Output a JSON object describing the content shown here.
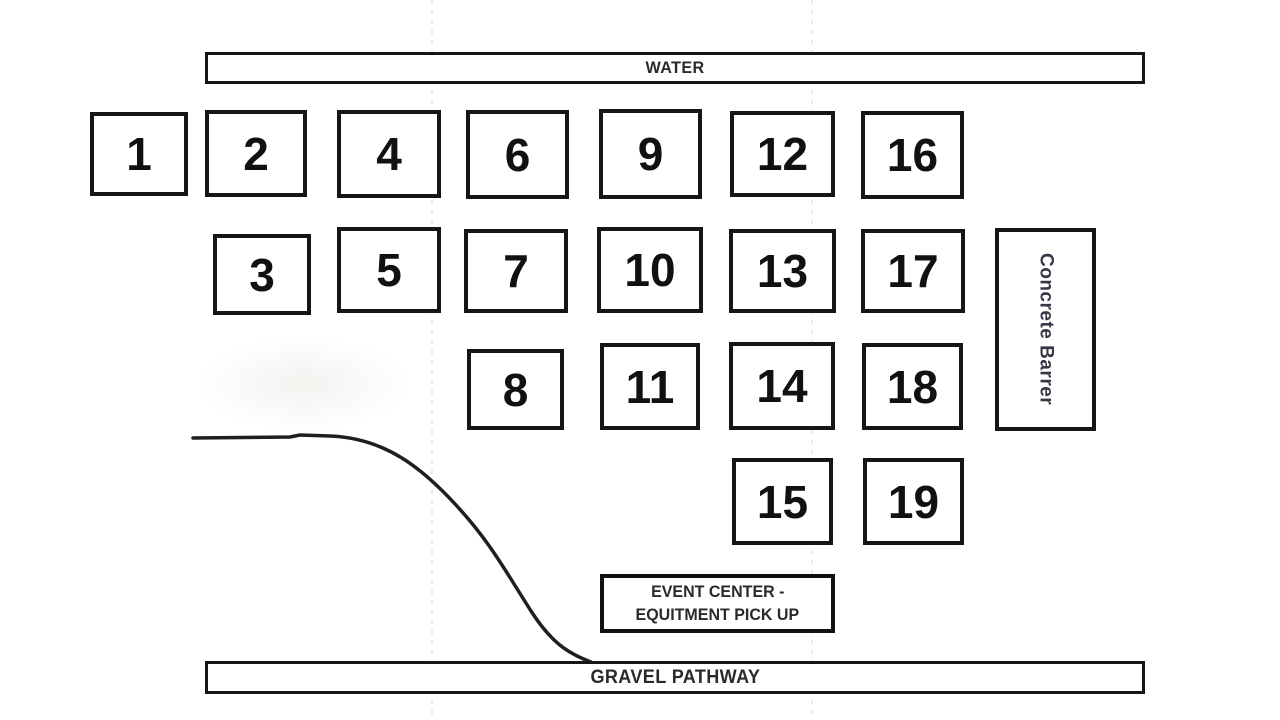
{
  "diagram": {
    "water_bar": {
      "label": "WATER"
    },
    "gravel_bar": {
      "label": "GRAVEL PATHWAY"
    },
    "concrete_barrier": {
      "label": "Concrete Barrer"
    },
    "event_center": {
      "line1": "EVENT CENTER -",
      "line2": "EQUITMENT PICK UP"
    },
    "booths": [
      "1",
      "2",
      "3",
      "4",
      "5",
      "6",
      "7",
      "8",
      "9",
      "10",
      "11",
      "12",
      "13",
      "14",
      "15",
      "16",
      "17",
      "18",
      "19"
    ]
  },
  "colors": {
    "background": "#ffffff",
    "ink": "#161616",
    "barrier_text": "#3c3547"
  }
}
